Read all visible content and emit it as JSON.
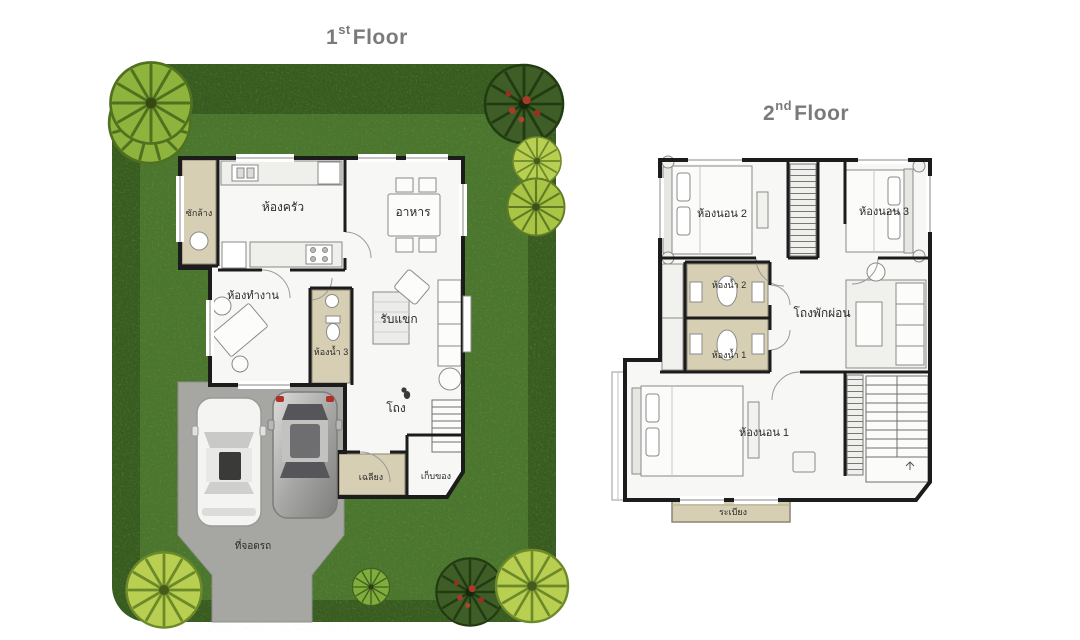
{
  "canvas": {
    "background": "#ffffff"
  },
  "colors": {
    "lawn": "#4c7a2e",
    "hedge": "#33571c",
    "tree_yellow": "#b9cf52",
    "tree_yellow_stroke": "#6c8a2a",
    "tree_green": "#7fae3d",
    "tree_green_stroke": "#44601f",
    "tree_dark": "#3f5e27",
    "tree_dark_stroke": "#223c12",
    "tree_red": "#a83a28",
    "driveway": "#a6a6a2",
    "wall": "#1c1c1c",
    "tile": "#d6cfb4",
    "interior": "#f7f7f5",
    "furniture_stroke": "#8a8a88",
    "title_text": "#7a7a7a",
    "label_text": "#2b2b2b"
  },
  "floor1": {
    "title": {
      "number": "1",
      "suffix": "st",
      "word": "Floor"
    },
    "rooms": {
      "laundry": "ซักล้าง",
      "kitchen": "ห้องครัว",
      "dining": "อาหาร",
      "office": "ห้องทำงาน",
      "bathroom3": "ห้องน้ำ 3",
      "living": "รับแขก",
      "hall": "โถง",
      "porch": "เฉลียง",
      "storage": "เก็บของ",
      "carpark": "ที่จอดรถ"
    }
  },
  "floor2": {
    "title": {
      "number": "2",
      "suffix": "nd",
      "word": "Floor"
    },
    "rooms": {
      "bedroom2": "ห้องนอน 2",
      "bedroom3": "ห้องนอน 3",
      "bathroom2": "ห้องน้ำ 2",
      "bathroom1": "ห้องน้ำ 1",
      "lounge": "โถงพักผ่อน",
      "bedroom1": "ห้องนอน 1",
      "balcony": "ระเบียง"
    }
  }
}
